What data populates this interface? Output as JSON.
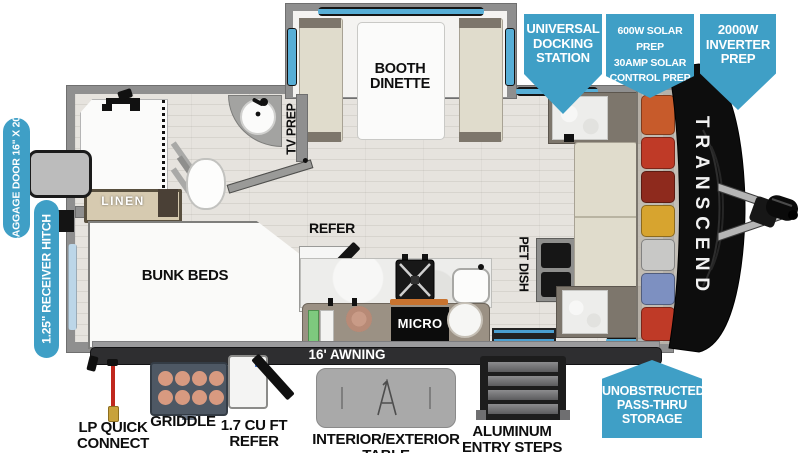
{
  "brand": {
    "model_vertical": "TRANSCEND"
  },
  "callouts": {
    "universal_docking_station": "UNIVERSAL\nDOCKING\nSTATION",
    "solar_prep": "600W SOLAR PREP\n30AMP SOLAR\nCONTROL PREP",
    "inverter_prep": "2000W\nINVERTER\nPREP",
    "pass_thru_storage": "UNOBSTRUCTED\nPASS-THRU\nSTORAGE",
    "baggage_door": "BAGGAGE DOOR\n16\" X 20\"",
    "receiver_hitch": "1.25\" RECEIVER HITCH",
    "accent_color": "#3f9fc6"
  },
  "interior_labels": {
    "booth_dinette": "BOOTH\nDINETTE",
    "tv_prep": "TV PREP",
    "linen": "LINEN",
    "bunk_beds": "BUNK BEDS",
    "refer": "REFER",
    "pet_dish": "PET DISH",
    "micro": "MICRO",
    "awning": "16' AWNING"
  },
  "exterior_labels": {
    "lp_quick_connect": "LP QUICK\nCONNECT",
    "griddle": "GRIDDLE",
    "compact_refer": "1.7 CU FT\nREFER",
    "table": "INTERIOR/EXTERIOR TABLE",
    "entry_steps": "ALUMINUM\nENTRY STEPS"
  },
  "pass_thru_storage_items": [
    {
      "name": "gear-orange",
      "color": "#c75b2b"
    },
    {
      "name": "gear-red",
      "color": "#bf3a27"
    },
    {
      "name": "gear-maroon",
      "color": "#8e2a1d"
    },
    {
      "name": "gear-yellow",
      "color": "#d7a42f"
    },
    {
      "name": "gear-silver",
      "color": "#c8c8c6"
    },
    {
      "name": "gear-blue",
      "color": "#7d90c1"
    },
    {
      "name": "gear-red-2",
      "color": "#bf3a27"
    }
  ],
  "colors": {
    "callout_blue": "#3f9fc6",
    "wall_gray": "#8f8f8f",
    "front_cap_black": "#0d0d0d",
    "window_blue": "#57aed6",
    "awning_bar": "#2e2e30"
  }
}
